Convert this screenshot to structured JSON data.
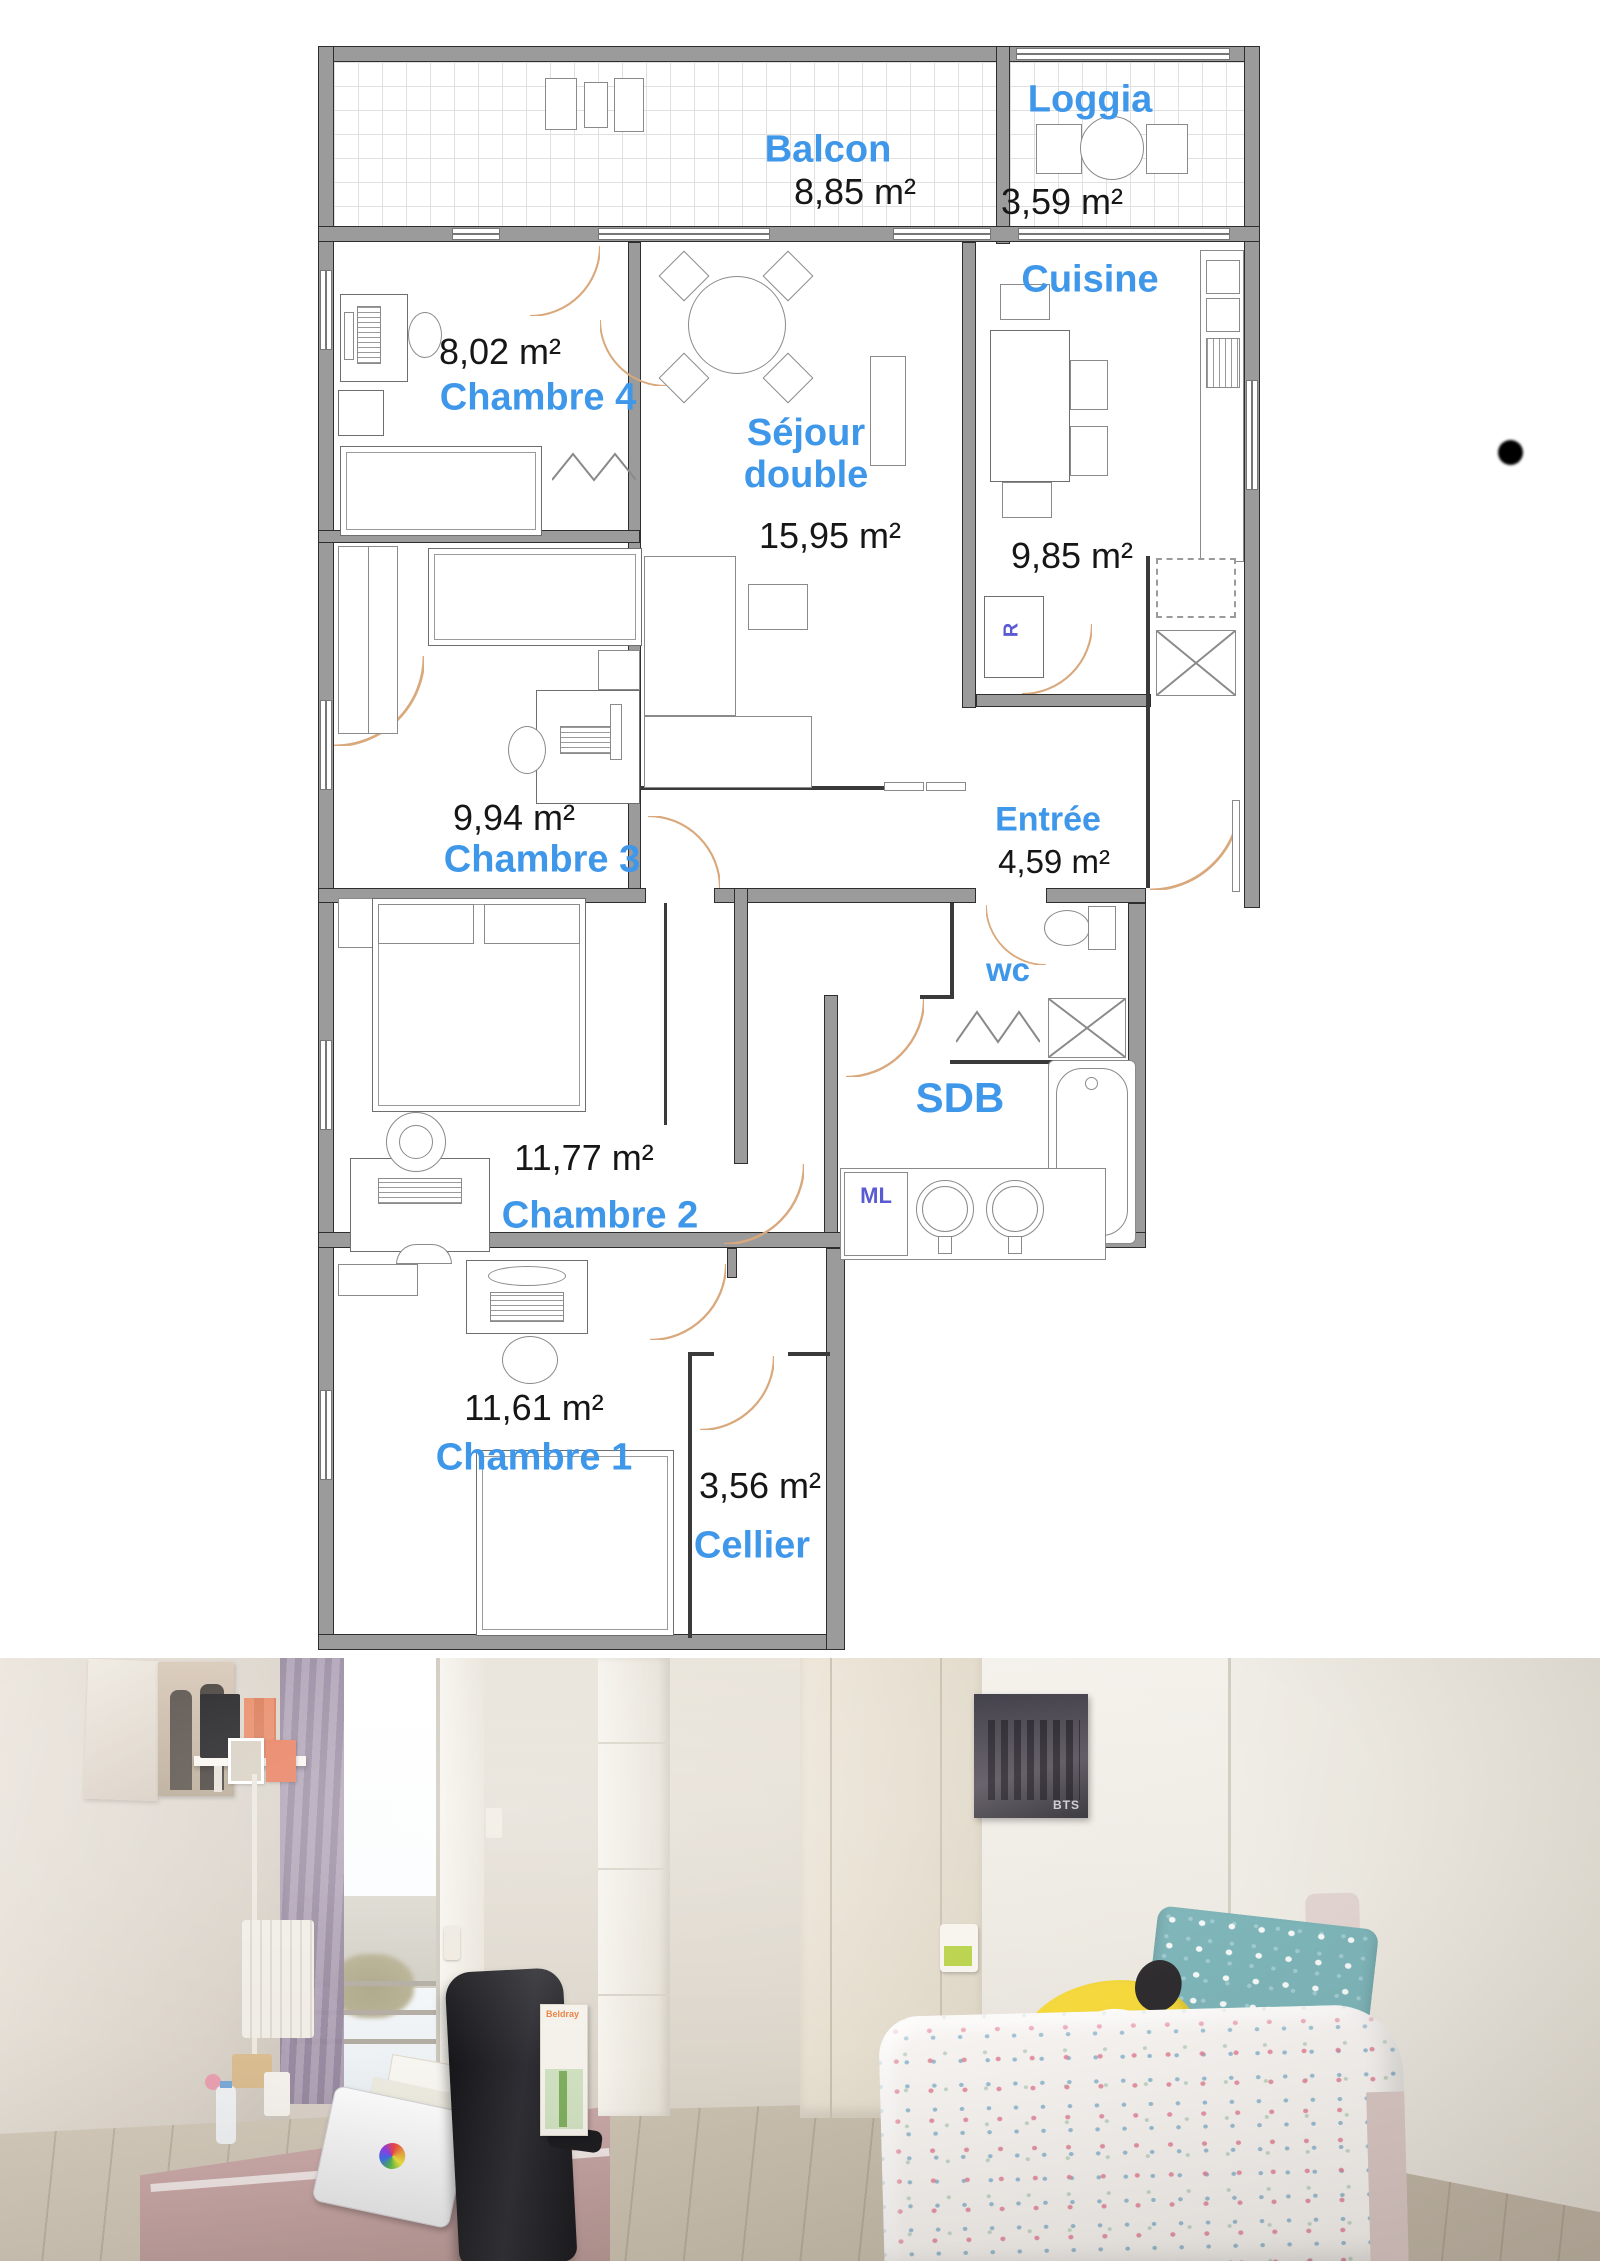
{
  "floor_plan": {
    "rooms": [
      {
        "name": "Balcon",
        "area": "8,85 m²"
      },
      {
        "name": "Loggia",
        "area": "3,59 m²"
      },
      {
        "name": "Cuisine",
        "area": "9,85 m²"
      },
      {
        "name": "Chambre 4",
        "area": "8,02 m²"
      },
      {
        "name": "Séjour double",
        "area": "15,95 m²"
      },
      {
        "name": "Chambre 3",
        "area": "9,94 m²"
      },
      {
        "name": "Entrée",
        "area": "4,59 m²"
      },
      {
        "name": "wc",
        "area": ""
      },
      {
        "name": "SDB",
        "area": ""
      },
      {
        "name": "Chambre 2",
        "area": "11,77 m²"
      },
      {
        "name": "Chambre 1",
        "area": "11,61 m²"
      },
      {
        "name": "Cellier",
        "area": "3,56 m²"
      }
    ],
    "annotations": {
      "fridge": "R",
      "washing_machine": "ML"
    },
    "colors": {
      "room_label": "#3f97ea",
      "area_text": "#161616",
      "wall": "#9b9b9b",
      "door_arc": "#d9a87c",
      "annotation": "#5a5ad2"
    }
  },
  "photo": {
    "poster_text": "BTS",
    "box_text": "Beldray"
  }
}
